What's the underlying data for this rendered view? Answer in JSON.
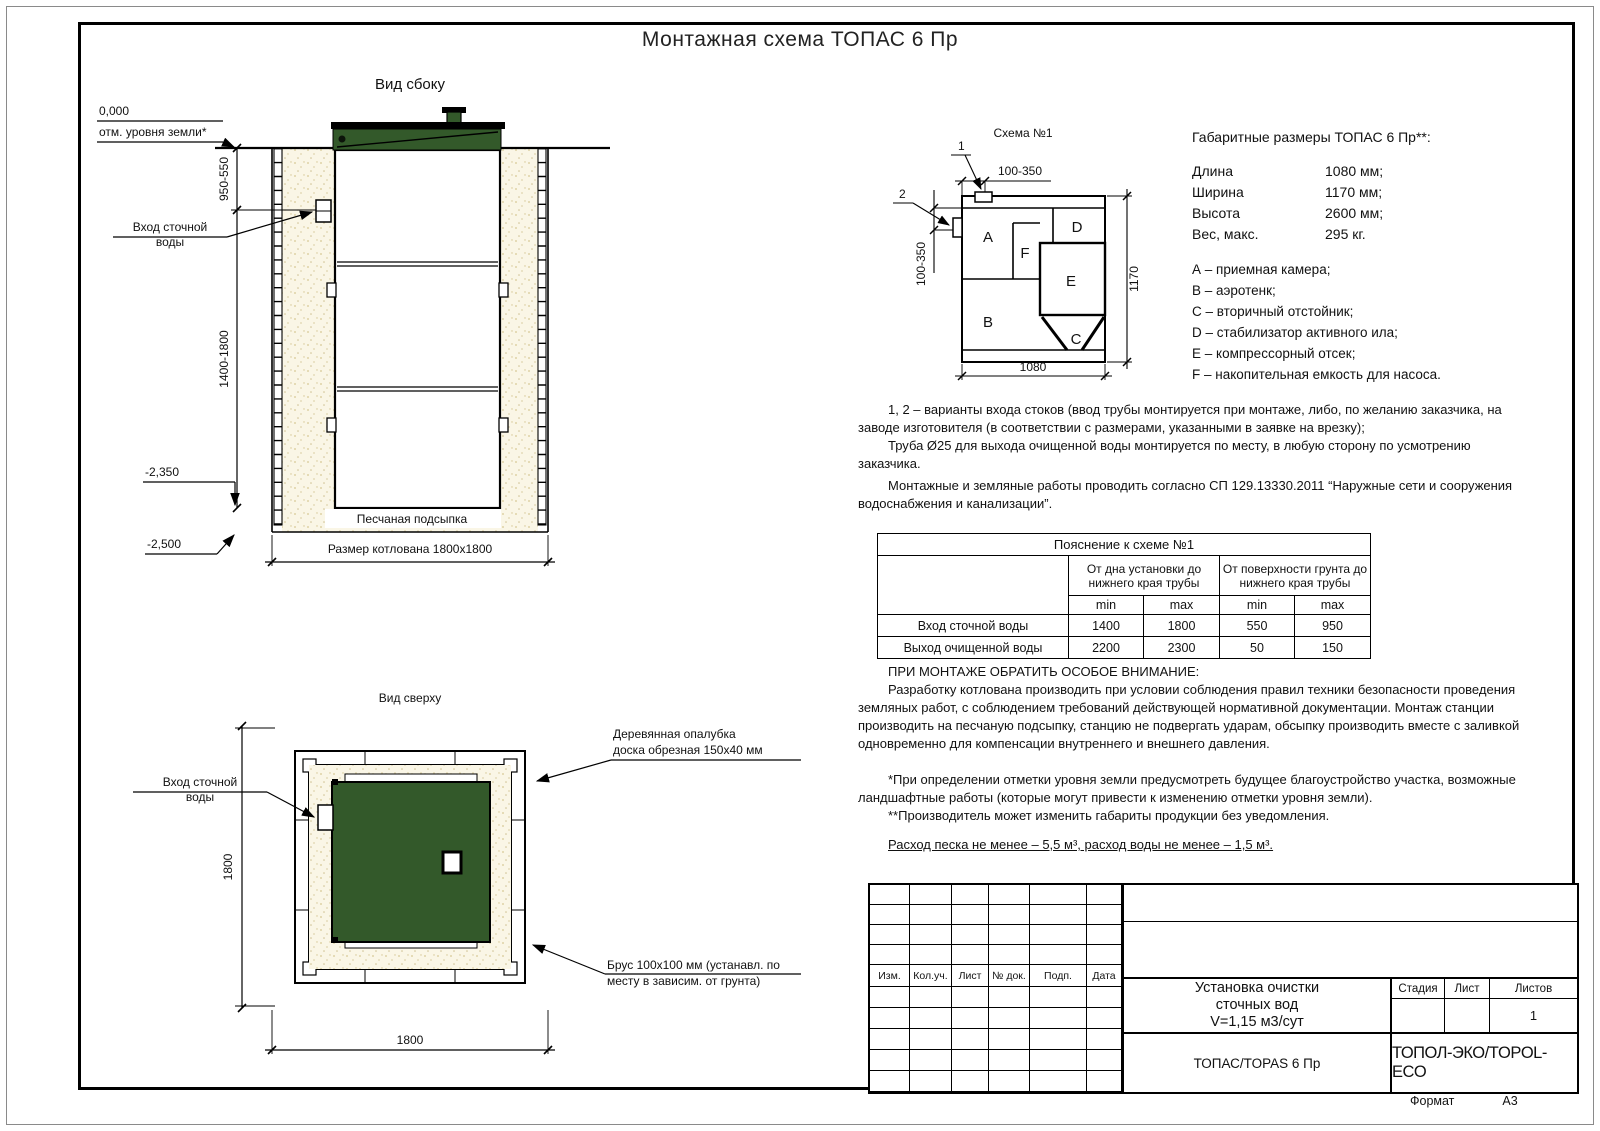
{
  "sheet": {
    "title": "Монтажная схема ТОПАС 6 Пр",
    "format_label": "Формат",
    "format_value": "А3"
  },
  "side_view": {
    "title": "Вид сбоку",
    "zero_mark": "0,000",
    "ground_label": "отм. уровня земли*",
    "dim_depth_top": "950-550",
    "dim_depth_main": "1400-1800",
    "inlet_line1": "Вход сточной",
    "inlet_line2": "воды",
    "mark_sand": "-2,350",
    "mark_bottom": "-2,500",
    "sand_label": "Песчаная подсыпка",
    "pit_label": "Размер котлована 1800х1800"
  },
  "top_view": {
    "title": "Вид сверху",
    "inlet_line1": "Вход сточной",
    "inlet_line2": "воды",
    "formwork_line1": "Деревянная опалубка",
    "formwork_line2": "доска обрезная 150х40 мм",
    "beam_line1": "Брус 100х100 мм (устанавл. по",
    "beam_line2": "месту в зависим. от грунта)",
    "dim_width": "1800",
    "dim_height": "1800"
  },
  "scheme": {
    "title": "Схема №1",
    "marker_1": "1",
    "marker_2": "2",
    "dim_top": "100-350",
    "dim_left": "100-350",
    "dim_bottom": "1080",
    "dim_right": "1170",
    "labels": {
      "a": "A",
      "b": "B",
      "c": "C",
      "d": "D",
      "e": "E",
      "f": "F"
    }
  },
  "specs": {
    "heading": "Габаритные размеры ТОПАС 6 Пр**:",
    "rows": [
      {
        "label": "Длина",
        "value": "1080 мм;"
      },
      {
        "label": "Ширина",
        "value": "1170 мм;"
      },
      {
        "label": "Высота",
        "value": "2600 мм;"
      },
      {
        "label": "Вес, макс.",
        "value": "295 кг."
      }
    ],
    "legend": [
      "А – приемная камера;",
      "В – аэротенк;",
      "С – вторичный отстойник;",
      "D – стабилизатор активного ила;",
      "Е – компрессорный отсек;",
      "F – накопительная емкость для насоса."
    ]
  },
  "notes": {
    "variants_1": "1, 2 – варианты входа  стоков (ввод трубы монтируется при монтаже, либо, по желанию заказчика, на заводе изготовителя (в соответствии с размерами, указанными в заявке на врезку);",
    "variants_2": "Труба Ø25 для выхода очищенной воды монтируется по месту, в любую сторону по усмотрению заказчика.",
    "works": "Монтажные и земляные работы проводить согласно СП 129.13330.2011 “Наружные сети и сооружения водоснабжения и канализации”."
  },
  "table": {
    "title": "Пояснение к схеме №1",
    "col_group_1": "От дна установки до нижнего края трубы",
    "col_group_2": "От поверхности грунта до нижнего края трубы",
    "min": "min",
    "max": "max",
    "rows": [
      {
        "label": "Вход сточной воды",
        "v1": "1400",
        "v2": "1800",
        "v3": "550",
        "v4": "950"
      },
      {
        "label": "Выход очищенной воды",
        "v1": "2200",
        "v2": "2300",
        "v3": "50",
        "v4": "150"
      }
    ]
  },
  "attention": {
    "heading": "ПРИ МОНТАЖЕ ОБРАТИТЬ ОСОБОЕ ВНИМАНИЕ:",
    "body": "Разработку котлована производить при условии соблюдения правил техники безопасности проведения земляных работ, с соблюдением требований действующей нормативной документации. Монтаж станции производить на песчаную подсыпку, станцию не подвергать ударам, обсыпку производить вместе с заливкой одновременно для компенсации внутреннего и внешнего давления.",
    "footnote_1": "*При определении отметки уровня земли предусмотреть будущее благоустройство участка, возможные ландшафтные работы (которые могут привести к изменению отметки уровня земли).",
    "footnote_2": "**Производитель может изменить габариты продукции без уведомления.",
    "consumption": "Расход песка не менее – 5,5 м³, расход воды не менее – 1,5 м³."
  },
  "title_block": {
    "rev_headers": [
      "Изм.",
      "Кол.уч.",
      "Лист",
      "№ док.",
      "Подп.",
      "Дата"
    ],
    "doc_title_1": "Установка очистки",
    "doc_title_2": "сточных вод",
    "doc_title_3": "V=1,15 м3/сут",
    "stage_label": "Стадия",
    "sheet_label": "Лист",
    "sheets_label": "Листов",
    "sheets_value": "1",
    "model": "ТОПАС/TOPAS 6 Пр",
    "company": "ТОПОЛ-ЭКО/TOPOL-ECO"
  },
  "colors": {
    "lid_green": "#33592a",
    "sand": "#faf6e6",
    "line": "#000000"
  }
}
